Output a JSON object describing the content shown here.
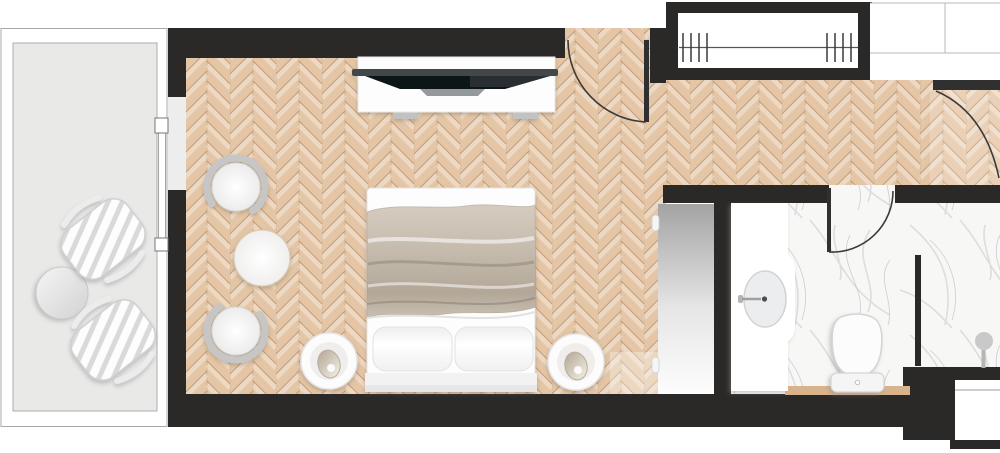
{
  "plan": {
    "kind": "hotel-room-floor-plan",
    "regions": [
      {
        "name": "balcony",
        "floor": "concrete-gray"
      },
      {
        "name": "bedroom",
        "floor": "herringbone-parquet"
      },
      {
        "name": "entry-hall",
        "floor": "herringbone-parquet"
      },
      {
        "name": "closet",
        "feature": "hanging-rail"
      },
      {
        "name": "luggage-counter",
        "feature": "shelf-grid"
      },
      {
        "name": "bathroom",
        "floor": "marble"
      },
      {
        "name": "shower-area",
        "floor": "marble"
      }
    ],
    "furniture": [
      {
        "name": "lounge-chair",
        "count": 2,
        "location": "balcony"
      },
      {
        "name": "balcony-side-table",
        "count": 1,
        "location": "balcony"
      },
      {
        "name": "sliding-glass-door",
        "count": 1,
        "location": "balcony-wall"
      },
      {
        "name": "armchair",
        "count": 2,
        "location": "bedroom"
      },
      {
        "name": "round-table",
        "count": 1,
        "location": "bedroom"
      },
      {
        "name": "tv-console-with-tv",
        "count": 1,
        "location": "bedroom"
      },
      {
        "name": "double-bed-with-two-pillows",
        "count": 1,
        "location": "bedroom"
      },
      {
        "name": "nightstand-with-lamp",
        "count": 2,
        "location": "bedroom"
      },
      {
        "name": "wardrobe-panel",
        "count": 1,
        "location": "bedroom"
      },
      {
        "name": "hanging-rail-with-hangers",
        "count": 1,
        "location": "closet"
      },
      {
        "name": "vanity-with-basin",
        "count": 1,
        "location": "bathroom"
      },
      {
        "name": "toilet-with-tank",
        "count": 1,
        "location": "bathroom"
      },
      {
        "name": "shower-head",
        "count": 1,
        "location": "shower-area"
      },
      {
        "name": "wooden-bench-strip",
        "count": 1,
        "location": "bathroom"
      },
      {
        "name": "utility-box",
        "count": 1,
        "location": "exterior-bottom-right"
      }
    ],
    "doors": [
      {
        "name": "entry-door",
        "type": "swing"
      },
      {
        "name": "hall-door",
        "type": "swing"
      },
      {
        "name": "bathroom-door",
        "type": "swing"
      },
      {
        "name": "balcony-sliding-door",
        "type": "sliding"
      }
    ]
  },
  "palette": {
    "wall": "#2a2928",
    "parquet-base": "#e4c6a6",
    "balcony-floor": "#e9e9e8",
    "marble-base": "#f7f7f6",
    "wood-accent": "#d8b38c",
    "door-line": "#3a3a3a",
    "frame-line": "#a8a8a8",
    "blanket": "#c3b9ab",
    "stripe": "#d9d9d9",
    "chair-ring": "#c6c6c6"
  }
}
